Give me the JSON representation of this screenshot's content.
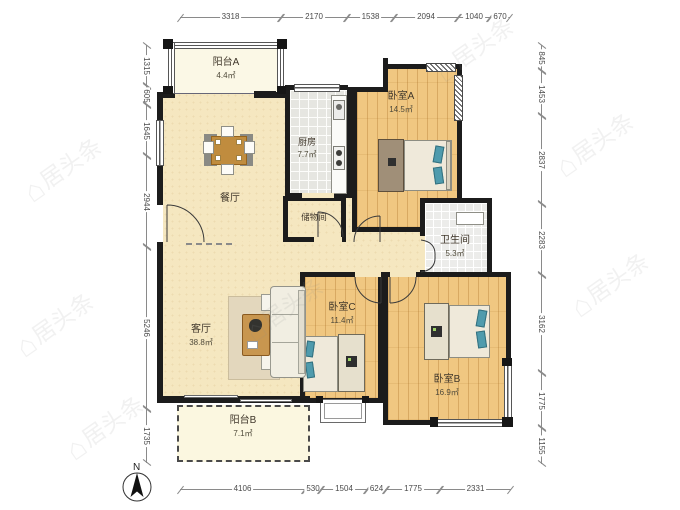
{
  "plan": {
    "compass_label": "N",
    "watermark_text": "居头条",
    "watermark_icon_glyph": "⌂",
    "wall_color": "#1c1c1c",
    "wood_color": "#f0c781",
    "cream_color": "#f5e7c0",
    "pillow_accent_color": "#4f9bad"
  },
  "rooms": {
    "balcony_a": {
      "name": "阳台A",
      "area": "4.4㎡"
    },
    "dining": {
      "name": "餐厅",
      "area": ""
    },
    "kitchen": {
      "name": "厨房",
      "area": "7.7㎡"
    },
    "bedroom_a": {
      "name": "卧室A",
      "area": "14.5㎡"
    },
    "storage": {
      "name": "储物间",
      "area": ""
    },
    "bathroom": {
      "name": "卫生间",
      "area": "5.3㎡"
    },
    "living": {
      "name": "客厅",
      "area": "38.8㎡"
    },
    "bedroom_c": {
      "name": "卧室C",
      "area": "11.4㎡"
    },
    "bedroom_b": {
      "name": "卧室B",
      "area": "16.9㎡"
    },
    "balcony_b": {
      "name": "阳台B",
      "area": "7.1㎡"
    }
  },
  "dimensions": {
    "top": [
      "3318",
      "2170",
      "1538",
      "2094",
      "1040",
      "670"
    ],
    "left": [
      "1315",
      "605",
      "1645",
      "2944",
      "5246",
      "1735"
    ],
    "right": [
      "845",
      "1453",
      "2837",
      "2283",
      "3162",
      "1775",
      "1155"
    ],
    "bottom": [
      "4106",
      "530",
      "1504",
      "624",
      "1775",
      "2331"
    ]
  }
}
